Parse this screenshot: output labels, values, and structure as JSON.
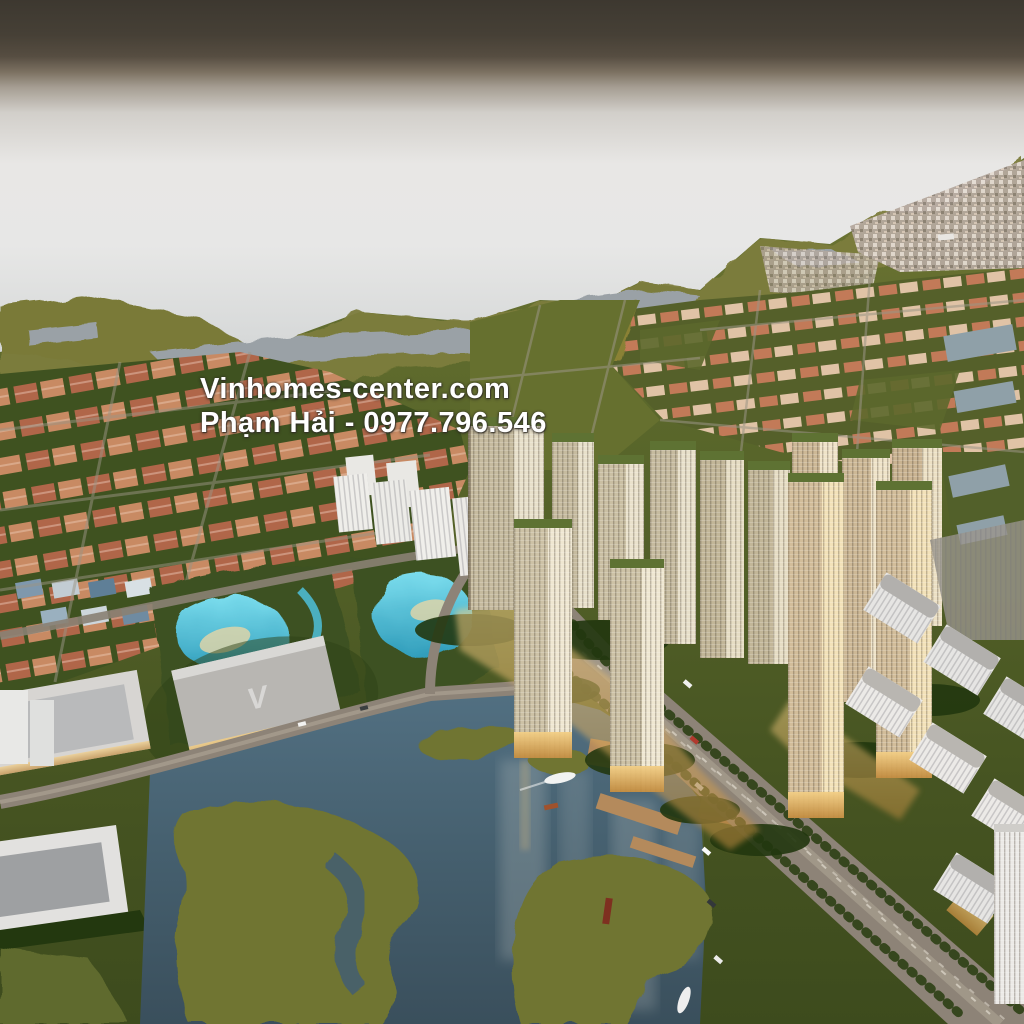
{
  "watermark": {
    "line1": "Vinhomes-center.com",
    "line2": "Phạm Hải - 0977.796.546",
    "text_color": "#ffffff",
    "shadow_color": "#4a453e"
  },
  "mall_roof_logo": "V",
  "palette": {
    "sky_band_top": "#3d3830",
    "haze_white": "#e8e7e5",
    "sea_gray": "#abb0b4",
    "marsh_olive": "#7d7d3c",
    "field_green": "#5a672b",
    "villa_roof_orange": "#b06649",
    "tower_facade_beige": "#c6bb9f",
    "tower_roof_green": "#5e7233",
    "tower_base_glow": "#d9a656",
    "lagoon_turquoise": "#53c3d8",
    "lake_slate": "#46606e",
    "road_taupe": "#8d8377",
    "white_building": "#e6e5e3"
  }
}
